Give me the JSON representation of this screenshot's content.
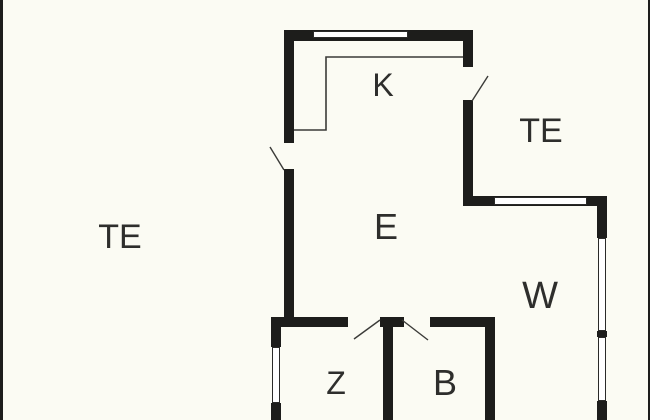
{
  "plan": {
    "width": 650,
    "height": 420,
    "background_color": "#FBFBF3",
    "wall_color": "#1D1D1B",
    "line_color": "#3B3B38",
    "label_color": "#2E2E2C",
    "window_fill": "#FFFFFF",
    "window_border": "#2A2A28"
  },
  "rooms": [
    {
      "name": "kitchen",
      "label": "K",
      "cx": 383,
      "cy": 85,
      "size": 32
    },
    {
      "name": "terrace-right",
      "label": "TE",
      "cx": 541,
      "cy": 131,
      "size": 34
    },
    {
      "name": "terrace-left",
      "label": "TE",
      "cx": 120,
      "cy": 237,
      "size": 34
    },
    {
      "name": "living-room",
      "label": "E",
      "cx": 386,
      "cy": 227,
      "size": 36
    },
    {
      "name": "room-w",
      "label": "W",
      "cx": 540,
      "cy": 296,
      "size": 38
    },
    {
      "name": "room-z",
      "label": "Z",
      "cx": 336,
      "cy": 383,
      "size": 32
    },
    {
      "name": "room-b",
      "label": "B",
      "cx": 445,
      "cy": 383,
      "size": 36
    }
  ],
  "walls": [
    {
      "name": "wall-top",
      "x": 284,
      "y": 30,
      "w": 189,
      "h": 11
    },
    {
      "name": "wall-left-upper",
      "x": 284,
      "y": 30,
      "w": 10,
      "h": 113
    },
    {
      "name": "wall-left-lower",
      "x": 284,
      "y": 169,
      "w": 10,
      "h": 148
    },
    {
      "name": "wall-kitchen-right-upper",
      "x": 463,
      "y": 41,
      "w": 10,
      "h": 26
    },
    {
      "name": "wall-kitchen-right-lower",
      "x": 463,
      "y": 100,
      "w": 10,
      "h": 106
    },
    {
      "name": "wall-terrace-bottom",
      "x": 463,
      "y": 196,
      "w": 144,
      "h": 10
    },
    {
      "name": "wall-right-upper",
      "x": 597,
      "y": 206,
      "w": 10,
      "h": 32
    },
    {
      "name": "wall-right-mid",
      "x": 597,
      "y": 331,
      "w": 10,
      "h": 6
    },
    {
      "name": "wall-right-lower",
      "x": 597,
      "y": 401,
      "w": 10,
      "h": 19
    },
    {
      "name": "wall-z-left-upper",
      "x": 271,
      "y": 317,
      "w": 10,
      "h": 30
    },
    {
      "name": "wall-z-left-lower",
      "x": 271,
      "y": 403,
      "w": 10,
      "h": 17
    },
    {
      "name": "wall-bottom-a",
      "x": 271,
      "y": 317,
      "w": 77,
      "h": 10
    },
    {
      "name": "wall-bottom-b",
      "x": 380,
      "y": 317,
      "w": 24,
      "h": 10
    },
    {
      "name": "wall-bottom-c",
      "x": 430,
      "y": 317,
      "w": 65,
      "h": 10
    },
    {
      "name": "wall-zb-divider",
      "x": 383,
      "y": 327,
      "w": 10,
      "h": 93
    },
    {
      "name": "wall-b-right",
      "x": 485,
      "y": 317,
      "w": 10,
      "h": 103
    }
  ],
  "windows": [
    {
      "name": "window-top",
      "x": 313,
      "y": 30.5,
      "w": 95,
      "h": 7
    },
    {
      "name": "window-terrace-wall",
      "x": 494,
      "y": 196.5,
      "w": 93,
      "h": 8
    },
    {
      "name": "window-right-upper",
      "x": 597.5,
      "y": 238,
      "w": 8,
      "h": 93
    },
    {
      "name": "window-right-lower",
      "x": 597.5,
      "y": 337,
      "w": 8,
      "h": 64
    },
    {
      "name": "window-z-left",
      "x": 271.5,
      "y": 347,
      "w": 8,
      "h": 56
    }
  ],
  "door_swings": [
    {
      "name": "door-swing-left-terrace",
      "x1": 270,
      "y1": 147,
      "x2": 284,
      "y2": 170
    },
    {
      "name": "door-swing-kitchen-right",
      "x1": 472,
      "y1": 101,
      "x2": 488,
      "y2": 76
    },
    {
      "name": "door-swing-room-z",
      "x1": 380,
      "y1": 320,
      "x2": 354,
      "y2": 339
    },
    {
      "name": "door-swing-room-b",
      "x1": 402,
      "y1": 320,
      "x2": 428,
      "y2": 340
    }
  ],
  "counter_line": {
    "name": "kitchen-counter-line",
    "points": "463,57 326,57 326,130 294,130"
  },
  "frame_edges": [
    {
      "name": "image-edge-left",
      "x": 0,
      "y": 0,
      "w": 2.5,
      "h": 420
    },
    {
      "name": "image-edge-right",
      "x": 647.5,
      "y": 0,
      "w": 2.5,
      "h": 420
    }
  ]
}
